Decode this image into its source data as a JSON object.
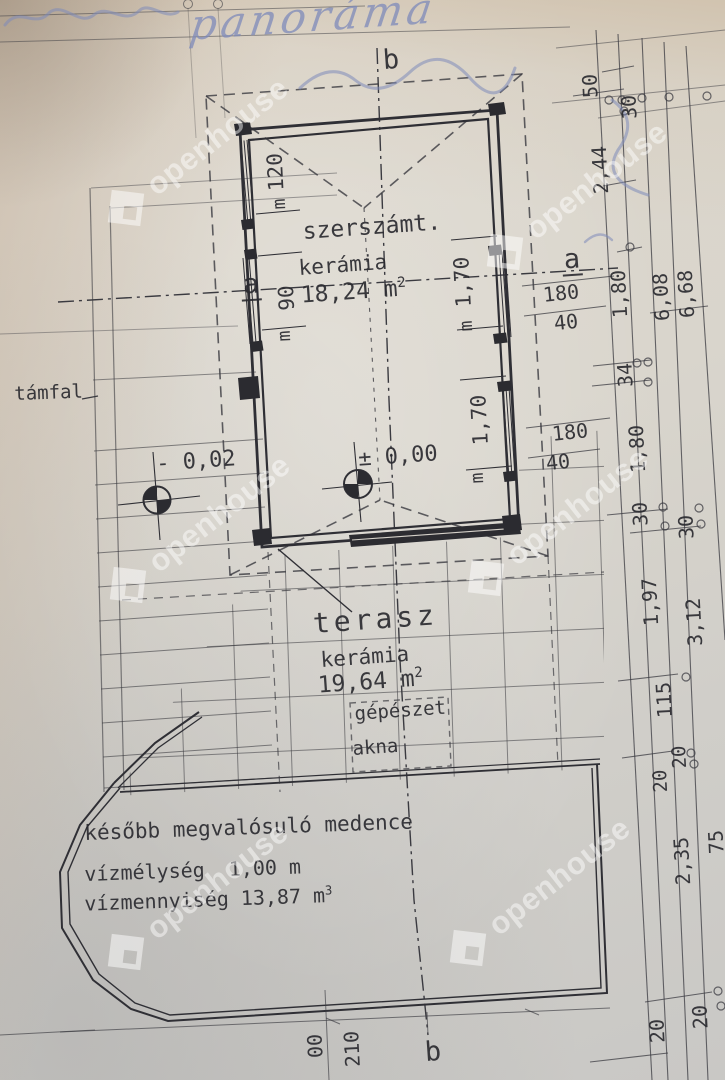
{
  "meta": {
    "kind": "photographed architectural floor plan",
    "language": "hu"
  },
  "watermark": {
    "text": "openhouse",
    "color": "#ffffff"
  },
  "handwriting": {
    "word": "panoráma",
    "ink_color": "#7d8ab9"
  },
  "rooms": {
    "toolshed": {
      "name": "szerszámt.",
      "material": "kerámia",
      "area": "18,24 m",
      "area_sup": "2"
    },
    "terrace": {
      "name": "terasz",
      "material": "kerámia",
      "area": "19,64 m",
      "area_sup": "2"
    },
    "mechanical": {
      "line1": "gépészet",
      "line2": "akna"
    },
    "pool": {
      "line1": "később megvalósuló medence",
      "line2": "vízmélység  1,00 m",
      "line3": "vízmennyiség 13,87 m",
      "line3_sup": "3"
    }
  },
  "labels": {
    "retaining_wall": "támfal"
  },
  "axes": {
    "a": "a",
    "b": "b"
  },
  "elevations": {
    "terrace_level": "- 0,02",
    "main_level": "± 0,00"
  },
  "dimensions": {
    "window_height_symbol": "m",
    "windows": [
      "120",
      "90",
      "1,70",
      "1,70"
    ],
    "right_horizontal": [
      "180",
      "40",
      "180",
      "40"
    ],
    "right_chain": [
      "50",
      "30",
      "2,44",
      "1,80",
      "6,08",
      "6,68",
      "34",
      "1,80",
      "30",
      "30",
      "1,97",
      "3,12",
      "115",
      "20",
      "20",
      "2,35",
      "75",
      "20",
      "20"
    ],
    "bottom": [
      "210",
      "00"
    ]
  },
  "colors": {
    "ink": "#3a3a40",
    "paper": "#d9d5cc"
  }
}
